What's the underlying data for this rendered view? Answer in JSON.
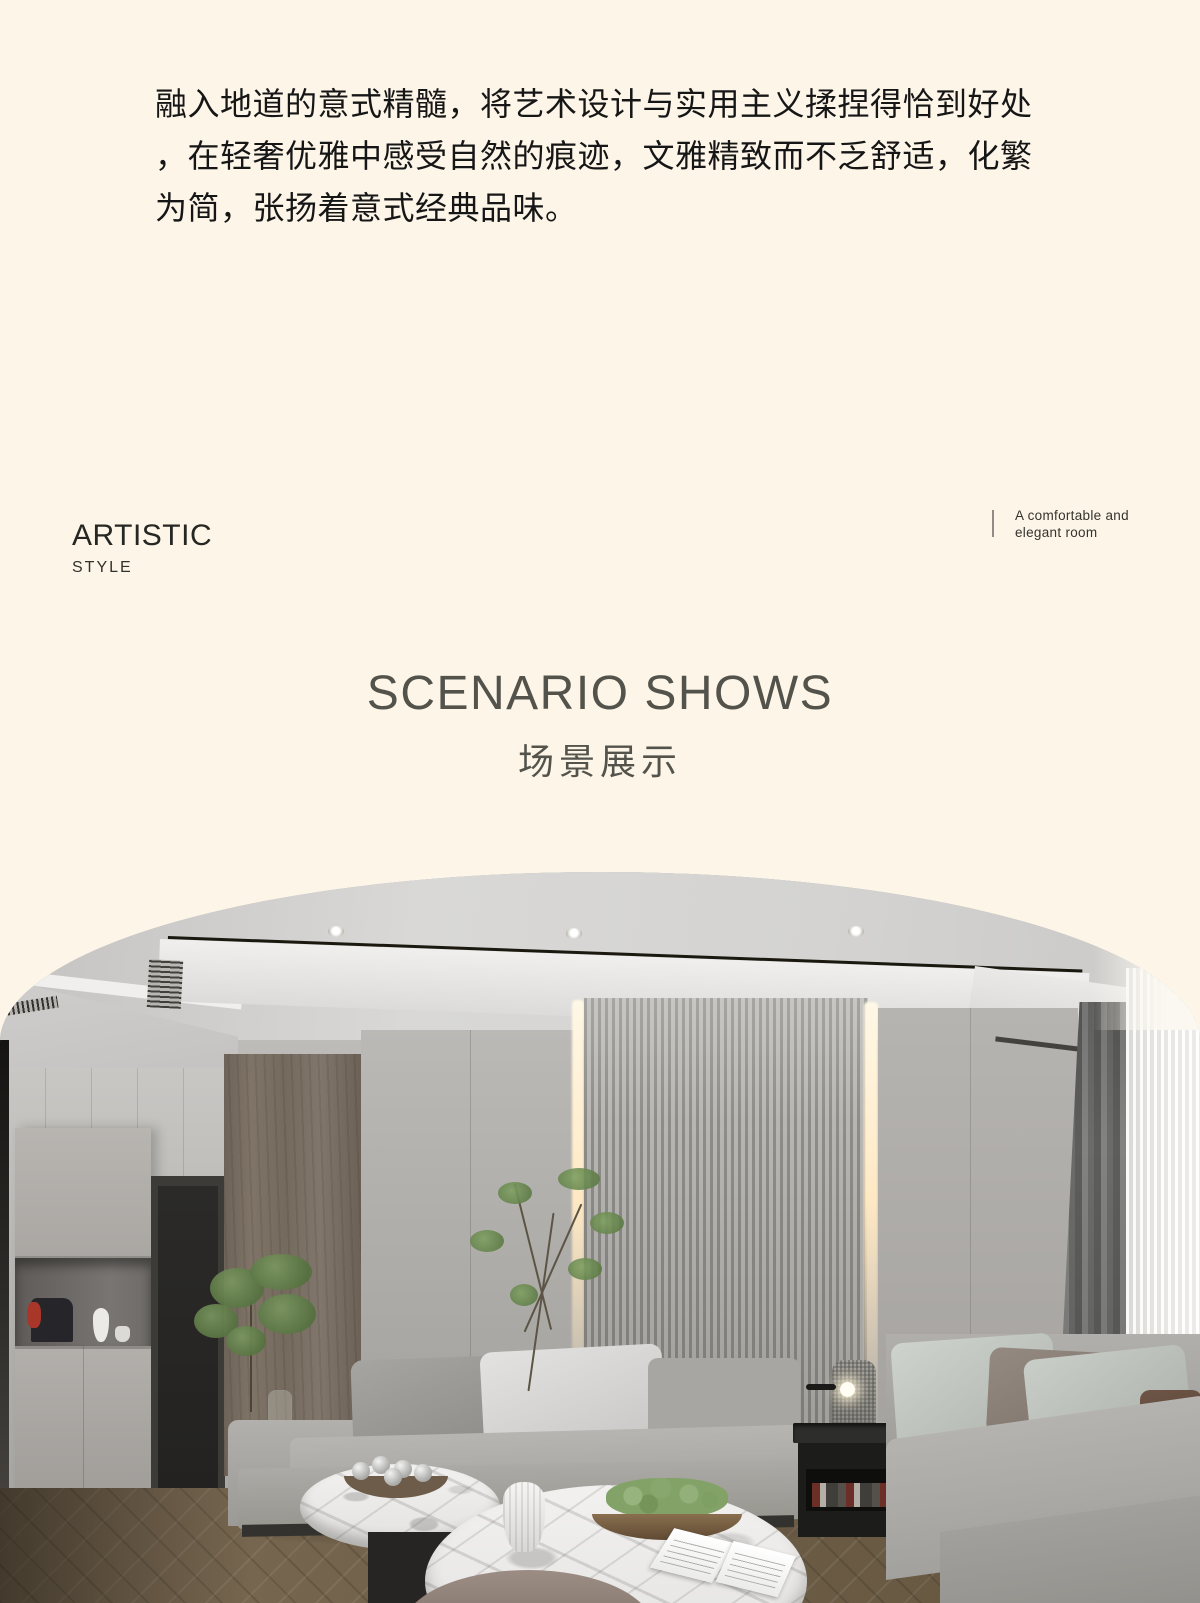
{
  "intro": {
    "lines": [
      "融入地道的意式精髓，将艺术设计与实用主义揉捏得恰到好处",
      "，在轻奢优雅中感受自然的痕迹，文雅精致而不乏舒适，化繁",
      "为简，张扬着意式经典品味。"
    ]
  },
  "artistic": {
    "title": "ARTISTIC",
    "subtitle": "STYLE"
  },
  "caption": {
    "lines": [
      "A comfortable and",
      "elegant room"
    ]
  },
  "section_heading": {
    "en": "SCENARIO SHOWS",
    "zh": "场景展示"
  },
  "theme": {
    "colors": {
      "cream": "#fcf5e8",
      "ink": "#161616",
      "heading": "#53534c",
      "caption": "#35332f",
      "divider": "#918d85",
      "wood": "#776c60",
      "sofa": "#a9a7a3",
      "pillow": "#e3e2e0",
      "marble": "#f2f1ef",
      "floor": "#6e5e48",
      "curtain": "#5d5d5b",
      "sheer": "#f4f2ee",
      "slat-dark": "#8e8c88",
      "slat-light": "#b8b6b2",
      "glow": "#ffe9c4",
      "accent-red": "#a8372a"
    }
  }
}
